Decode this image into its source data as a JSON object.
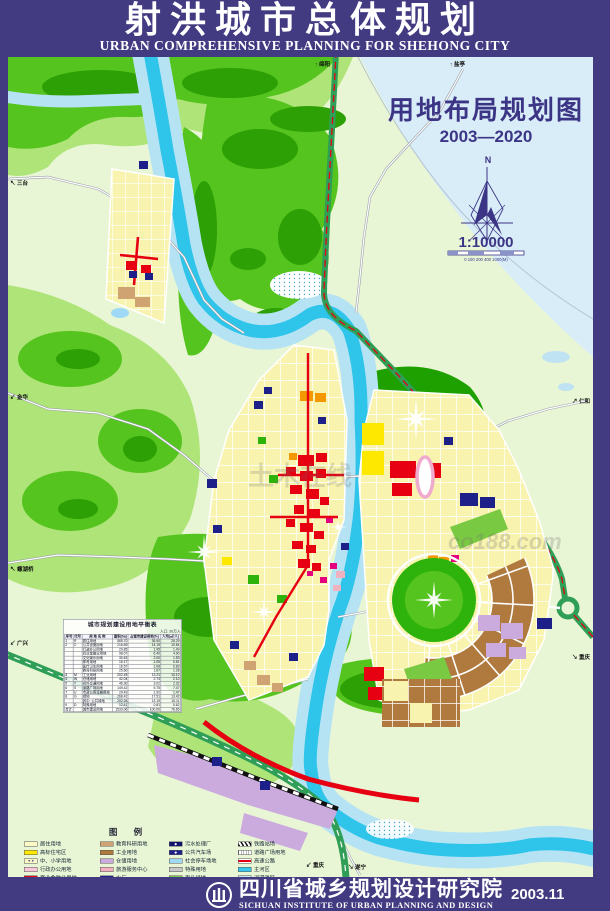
{
  "header": {
    "title_cn": "射洪城市总体规划",
    "title_en": "URBAN COMPREHENSIVE PLANNING FOR SHEHONG CITY"
  },
  "map": {
    "title": "用地布局规划图",
    "period": "2003—2020",
    "north": "N",
    "scale": "1:10000",
    "scale_ticks": "0  100  200      400                1000(M)",
    "watermark_a": "土木在线",
    "watermark_b": "co188.com",
    "edge_labels": {
      "mianyang": "绵阳",
      "yanting": "盐亭",
      "santai": "三台",
      "jinhua": "金华",
      "luohuqiao": "螺湖桥",
      "guangxing": "广兴",
      "renhe": "仁和",
      "chongqing_e": "重庆",
      "chongqing_s": "重庆",
      "suining": "遂宁"
    }
  },
  "balance_table": {
    "title": "城市规划建设用地平衡表",
    "note": "人口: 20万人",
    "columns": [
      "序号",
      "代号",
      "用 地 名 称",
      "面积(ha)",
      "占城市建设用地(%)",
      "人均(㎡/人)"
    ],
    "rows": [
      [
        "1",
        "R",
        "居住用地",
        "565.70",
        "36.90",
        "28.29"
      ],
      [
        "2",
        "C",
        "公共设施用地",
        "216.89",
        "14.15",
        "10.84"
      ],
      [
        "",
        "",
        "行政办公用地",
        "29.85",
        "1.95",
        "1.49"
      ],
      [
        "",
        "",
        "商业金融业用地",
        "98.07",
        "6.40",
        "4.90"
      ],
      [
        "",
        "",
        "文化娱乐用地",
        "30.63",
        "2.00",
        "1.53"
      ],
      [
        "",
        "",
        "体育用地",
        "16.17",
        "1.05",
        "0.81"
      ],
      [
        "",
        "",
        "医疗卫生用地",
        "16.57",
        "1.08",
        "0.83"
      ],
      [
        "",
        "",
        "教育科研用地",
        "25.60",
        "1.67",
        "1.28"
      ],
      [
        "3",
        "M",
        "工业用地",
        "202.45",
        "13.21",
        "10.12"
      ],
      [
        "4",
        "W",
        "仓储用地",
        "42.04",
        "2.74",
        "2.10"
      ],
      [
        "5",
        "T",
        "对外交通用地",
        "46.30",
        "3.02",
        "2.32"
      ],
      [
        "6",
        "S",
        "道路广场用地",
        "149.42",
        "9.75",
        "7.47"
      ],
      [
        "7",
        "U",
        "市政公用设施用地",
        "29.43",
        "1.92",
        "1.47"
      ],
      [
        "8",
        "G",
        "绿地",
        "268.42",
        "17.51",
        "13.42"
      ],
      [
        "",
        "",
        "其中: 公共绿地",
        "202.28",
        "13.19",
        "10.11"
      ],
      [
        "9",
        "D",
        "特殊用地",
        "12.41",
        "0.81",
        "0.62"
      ],
      [
        "合计",
        "",
        "城市建设用地",
        "1533.06",
        "100.00",
        "76.65"
      ]
    ]
  },
  "legend": {
    "title": "图 例",
    "columns": [
      [
        {
          "label": "居住用地",
          "type": "fill",
          "color": "#fdf9c4"
        },
        {
          "label": "高标住宅区",
          "type": "fill",
          "color": "#ffe800"
        },
        {
          "label": "中、小学用地",
          "type": "dots",
          "color": "#fdf9c4"
        },
        {
          "label": "行政办公用地",
          "type": "fill",
          "color": "#f8c8d8"
        },
        {
          "label": "商业金融业用地",
          "type": "fill",
          "color": "#e60012"
        },
        {
          "label": "市场用地",
          "type": "sym",
          "color": "#e60012",
          "sym": "◆"
        },
        {
          "label": "文化娱乐用地",
          "type": "fill",
          "color": "#f25c05"
        },
        {
          "label": "体育用地",
          "type": "fill",
          "color": "#f39800"
        },
        {
          "label": "医疗卫生用地",
          "type": "fill",
          "color": "#e4007f"
        },
        {
          "label": "旅馆用地",
          "type": "fill",
          "color": "#f5b56a"
        }
      ],
      [
        {
          "label": "教育科研用地",
          "type": "fill",
          "color": "#cfa472"
        },
        {
          "label": "工业用地",
          "type": "fill",
          "color": "#b07a3e"
        },
        {
          "label": "仓储用地",
          "type": "fill",
          "color": "#cbaade"
        },
        {
          "label": "旅游服务中心",
          "type": "fill",
          "color": "#f0b2c0"
        },
        {
          "label": "水厂",
          "type": "sym",
          "color": "#1d2088",
          "sym": "◆"
        },
        {
          "label": "环卫所",
          "type": "sym",
          "color": "#1d2088",
          "sym": "◆"
        },
        {
          "label": "邮电通讯用地",
          "type": "sym",
          "color": "#1d2088",
          "sym": "◆"
        },
        {
          "label": "配气站",
          "type": "sym",
          "color": "#1d2088",
          "sym": "◆"
        },
        {
          "label": "变电站",
          "type": "sym",
          "color": "#1d2088",
          "sym": "◆"
        },
        {
          "label": "客车站",
          "type": "sym",
          "color": "#1d2088",
          "sym": "◆"
        }
      ],
      [
        {
          "label": "污水处理厂",
          "type": "sym",
          "color": "#10146e",
          "sym": "◆"
        },
        {
          "label": "公共汽车场",
          "type": "sym",
          "color": "#1d2088",
          "sym": "◆"
        },
        {
          "label": "社会停车场地",
          "type": "fill",
          "color": "#9fd9f6"
        },
        {
          "label": "特殊用地",
          "type": "fill",
          "color": "#c8c8c8"
        },
        {
          "label": "街头绿地",
          "type": "fill",
          "color": "#7ac943"
        },
        {
          "label": "公园",
          "type": "fill",
          "color": "#2db30c"
        },
        {
          "label": "生态林地",
          "type": "fill",
          "color": "#eef7df"
        },
        {
          "label": "风景区",
          "type": "fill",
          "color": "#bfd730"
        },
        {
          "label": "防护绿地",
          "type": "fill",
          "color": "#00a875"
        },
        {
          "label": "草坡",
          "type": "fill",
          "color": "#d8efc8"
        }
      ],
      [
        {
          "label": "铁路站场",
          "type": "rail"
        },
        {
          "label": "道路广场用地",
          "type": "ladder"
        },
        {
          "label": "高速公路",
          "type": "band"
        },
        {
          "label": "主河区",
          "type": "fill",
          "color": "#38c8ec"
        },
        {
          "label": "河漫滩区",
          "type": "fill",
          "color": "#c5e8f5"
        },
        {
          "label": "沙滩地",
          "type": "sand"
        },
        {
          "label": "防洪堤",
          "type": "dike"
        },
        {
          "label": "桥涵",
          "type": "bridge",
          "sym": "⊠"
        },
        {
          "label": "城镇区域性天然气输气干管",
          "type": "pipe"
        }
      ]
    ]
  },
  "footer": {
    "institute_cn": "四川省城乡规划设计研究院",
    "institute_en": "SICHUAN INSTITUTE OF URBAN PLANNING AND DESIGN",
    "date": "2003.11"
  }
}
